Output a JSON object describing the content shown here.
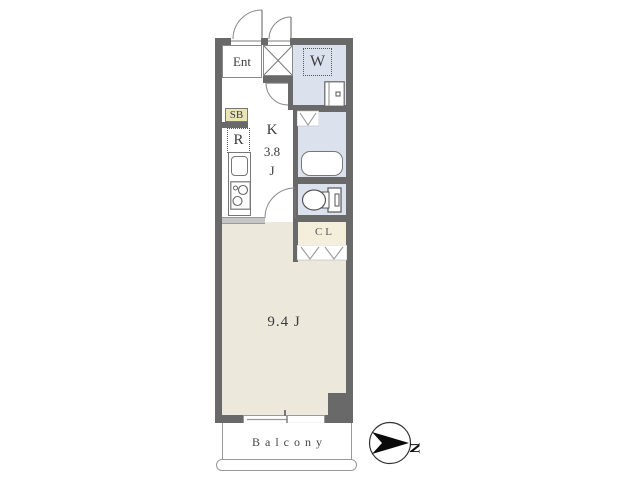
{
  "floor_plan": {
    "labels": {
      "entrance": "Ent",
      "washing_machine": "W",
      "shoe_box": "SB",
      "refrigerator": "R",
      "kitchen_letter": "K",
      "kitchen_size": "3.8",
      "kitchen_unit": "J",
      "closet": "CL",
      "main_room": "9.4 J",
      "balcony": "Balcony",
      "compass_north": "N"
    },
    "colors": {
      "page_bg": "#ffffff",
      "wall": "#696969",
      "floor_main_room": "#ece8db",
      "floor_wet_area": "#dbe2ee",
      "floor_closet": "#f3efdb",
      "shoe_box_bg": "#ebe4b4",
      "line": "#8a8a8a",
      "text": "#3c3c3c",
      "compass_arrow": "#0a0a0a"
    }
  }
}
